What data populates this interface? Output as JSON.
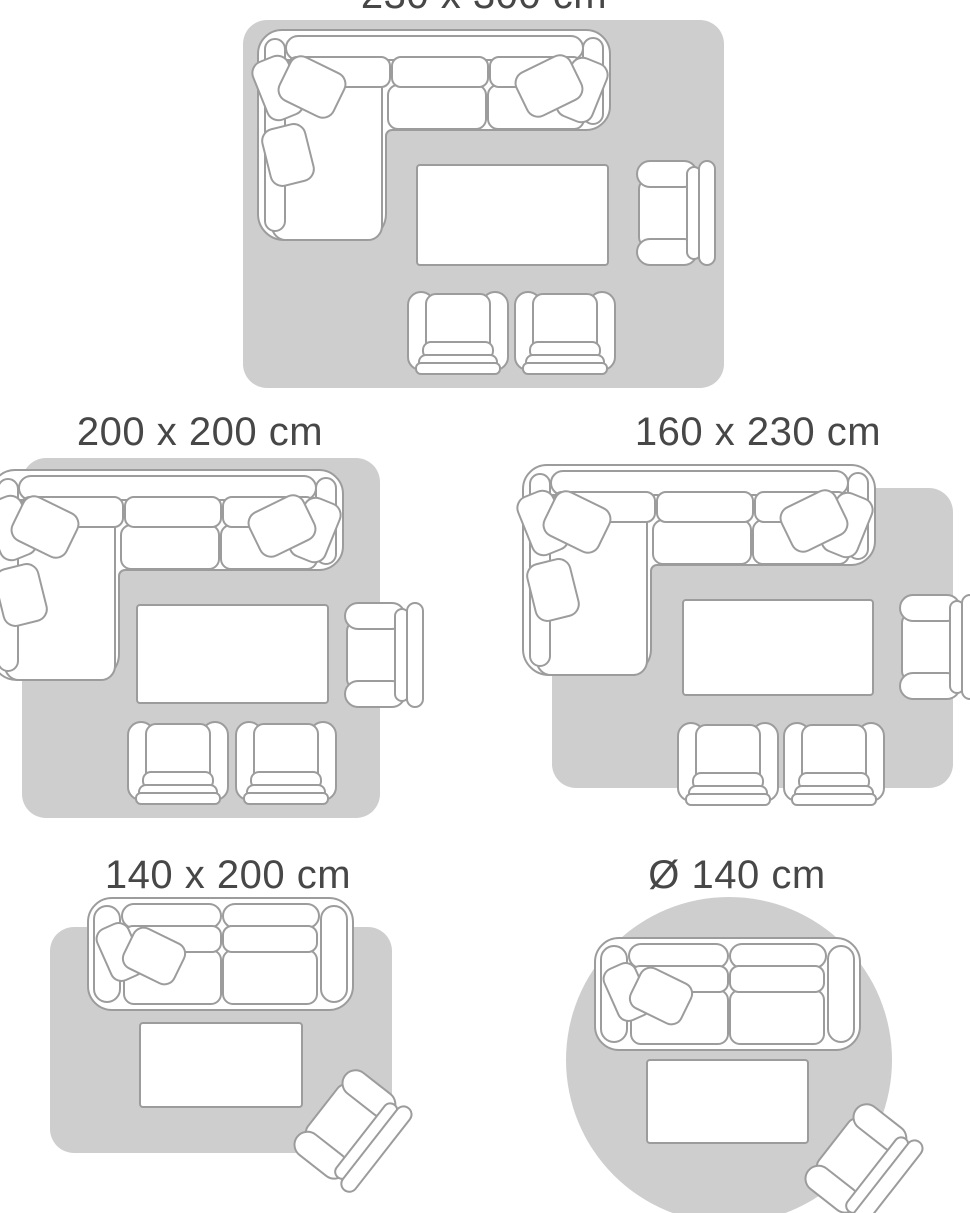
{
  "colors": {
    "background": "#ffffff",
    "rug_fill": "#cecece",
    "furniture_fill": "#ffffff",
    "furniture_outline": "#9c9c9c",
    "label_text": "#474747"
  },
  "size_guide": {
    "diagrams": [
      {
        "label": "230 x 300 cm",
        "rug_shape": "rectangle",
        "furniture": [
          "corner-sofa-with-cushions",
          "coffee-table",
          "armchair",
          "lounge-chair",
          "lounge-chair"
        ]
      },
      {
        "label": "200 x 200 cm",
        "rug_shape": "square",
        "furniture": [
          "corner-sofa-with-cushions",
          "coffee-table",
          "armchair",
          "lounge-chair",
          "lounge-chair"
        ]
      },
      {
        "label": "160 x 230 cm",
        "rug_shape": "rectangle",
        "furniture": [
          "corner-sofa-with-cushions",
          "coffee-table",
          "armchair",
          "lounge-chair",
          "lounge-chair"
        ]
      },
      {
        "label": "140 x 200 cm",
        "rug_shape": "rectangle",
        "furniture": [
          "two-seater-sofa-with-cushions",
          "coffee-table",
          "tilted-armchair"
        ]
      },
      {
        "label": "Ø 140 cm",
        "rug_shape": "circle",
        "furniture": [
          "two-seater-sofa-with-cushions",
          "coffee-table",
          "tilted-armchair"
        ]
      }
    ]
  }
}
